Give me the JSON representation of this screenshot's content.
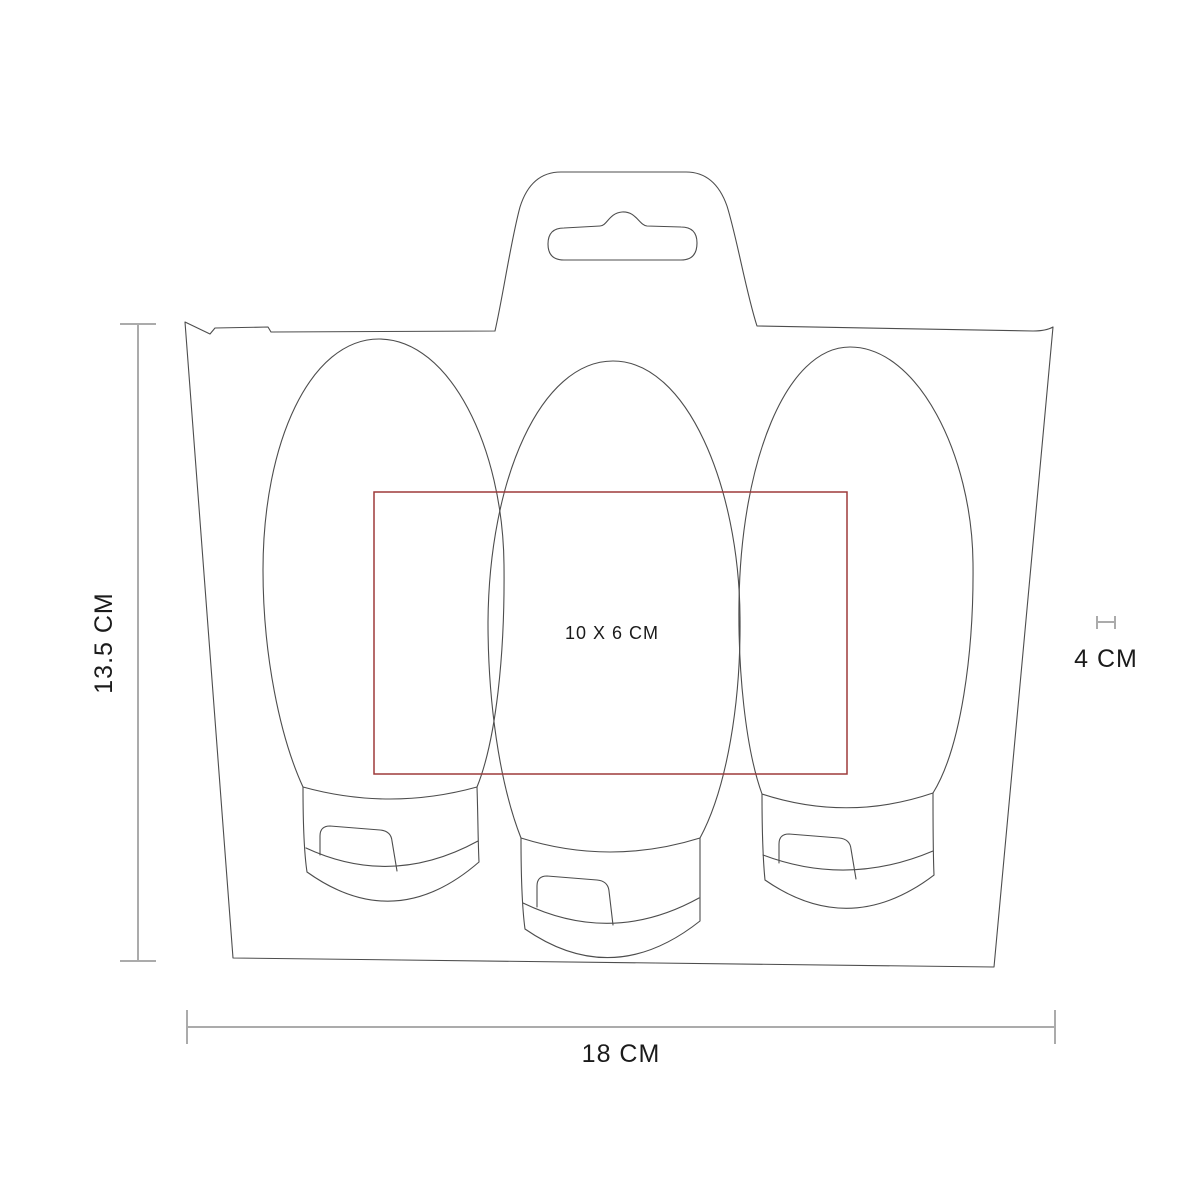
{
  "figure": {
    "kind": "product-dimension-diagram",
    "elements": [
      "blister-card",
      "hang-tab",
      "euro-slot-hole",
      "tube-left",
      "tube-middle",
      "tube-right",
      "imprint-area"
    ],
    "tube_count": 3
  },
  "labels": {
    "height": "13.5 CM",
    "width": "18 CM",
    "cap_width": "4 CM",
    "imprint_area": "10 X 6 CM"
  },
  "colors": {
    "outline": "#4d4d4d",
    "dimension": "#ababab",
    "imprint": "#9d3a3a",
    "label": "#1b1b1b",
    "background": "#ffffff"
  }
}
